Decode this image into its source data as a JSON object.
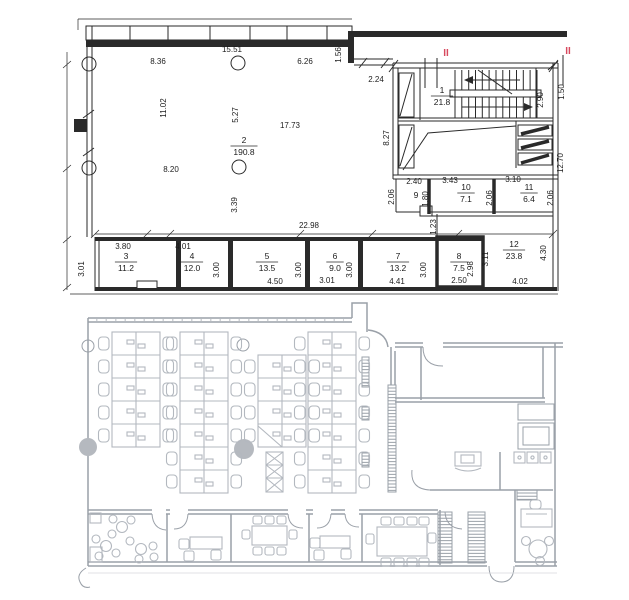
{
  "colors": {
    "ink": "#2a2a2a",
    "gray_wall": "#9aa0a8",
    "gray_furniture": "#b3b8bf",
    "marker_red": "#d84a5f"
  },
  "top_plan": {
    "section_markers": [
      {
        "label": "II",
        "x": 446,
        "y": 56
      },
      {
        "label": "II",
        "x": 568,
        "y": 54
      }
    ],
    "room_labels": [
      {
        "number": "1",
        "area": "21.8",
        "x": 442,
        "y": 96
      },
      {
        "number": "2",
        "area": "190.8",
        "x": 244,
        "y": 146
      },
      {
        "number": "3",
        "area": "11.2",
        "x": 126,
        "y": 262
      },
      {
        "number": "4",
        "area": "12.0",
        "x": 192,
        "y": 262
      },
      {
        "number": "5",
        "area": "13.5",
        "x": 267,
        "y": 262
      },
      {
        "number": "6",
        "area": "9.0",
        "x": 335,
        "y": 262
      },
      {
        "number": "7",
        "area": "13.2",
        "x": 398,
        "y": 262
      },
      {
        "number": "8",
        "area": "7.5",
        "x": 459,
        "y": 262
      },
      {
        "number": "10",
        "area": "7.1",
        "x": 466,
        "y": 193
      },
      {
        "number": "11",
        "area": "6.4",
        "x": 529,
        "y": 193
      },
      {
        "number": "12",
        "area": "23.8",
        "x": 514,
        "y": 250
      }
    ],
    "plain_labels": [
      {
        "text": "9",
        "x": 416,
        "y": 198
      }
    ],
    "dimensions": [
      {
        "text": "15.51",
        "x": 232,
        "y": 52,
        "rot": 0
      },
      {
        "text": "8.36",
        "x": 158,
        "y": 64,
        "rot": 0
      },
      {
        "text": "6.26",
        "x": 305,
        "y": 64,
        "rot": 0
      },
      {
        "text": "1.56",
        "x": 341,
        "y": 55,
        "rot": -90
      },
      {
        "text": "2.24",
        "x": 376,
        "y": 82,
        "rot": 0
      },
      {
        "text": "11.02",
        "x": 166,
        "y": 108,
        "rot": -90
      },
      {
        "text": "5.27",
        "x": 238,
        "y": 115,
        "rot": -90
      },
      {
        "text": "17.73",
        "x": 290,
        "y": 128,
        "rot": 0
      },
      {
        "text": "8.20",
        "x": 171,
        "y": 172,
        "rot": 0
      },
      {
        "text": "3.39",
        "x": 237,
        "y": 205,
        "rot": -90
      },
      {
        "text": "8.27",
        "x": 389,
        "y": 138,
        "rot": -90
      },
      {
        "text": "2.90",
        "x": 543,
        "y": 100,
        "rot": -90
      },
      {
        "text": "1.50",
        "x": 564,
        "y": 92,
        "rot": -90
      },
      {
        "text": "12.70",
        "x": 563,
        "y": 163,
        "rot": -90
      },
      {
        "text": "2.40",
        "x": 414,
        "y": 184,
        "rot": 0
      },
      {
        "text": "2.06",
        "x": 394,
        "y": 197,
        "rot": -90
      },
      {
        "text": "1.80",
        "x": 428,
        "y": 199,
        "rot": -90
      },
      {
        "text": "3.43",
        "x": 450,
        "y": 183,
        "rot": 0
      },
      {
        "text": "2.06",
        "x": 492,
        "y": 198,
        "rot": -90
      },
      {
        "text": "3.10",
        "x": 513,
        "y": 182,
        "rot": 0
      },
      {
        "text": "2.06",
        "x": 553,
        "y": 198,
        "rot": -90
      },
      {
        "text": "1.23",
        "x": 436,
        "y": 227,
        "rot": -90
      },
      {
        "text": "22.98",
        "x": 309,
        "y": 228,
        "rot": 0
      },
      {
        "text": "3.80",
        "x": 123,
        "y": 249,
        "rot": 0
      },
      {
        "text": "3.01",
        "x": 84,
        "y": 269,
        "rot": -90
      },
      {
        "text": "4.01",
        "x": 183,
        "y": 249,
        "rot": 0
      },
      {
        "text": "3.00",
        "x": 219,
        "y": 270,
        "rot": -90
      },
      {
        "text": "4.50",
        "x": 275,
        "y": 284,
        "rot": 0
      },
      {
        "text": "3.00",
        "x": 301,
        "y": 270,
        "rot": -90
      },
      {
        "text": "3.01",
        "x": 327,
        "y": 283,
        "rot": 0
      },
      {
        "text": "3.00",
        "x": 352,
        "y": 270,
        "rot": -90
      },
      {
        "text": "4.41",
        "x": 397,
        "y": 284,
        "rot": 0
      },
      {
        "text": "3.00",
        "x": 426,
        "y": 270,
        "rot": -90
      },
      {
        "text": "2.50",
        "x": 459,
        "y": 283,
        "rot": 0
      },
      {
        "text": "2.98",
        "x": 473,
        "y": 269,
        "rot": -90
      },
      {
        "text": "3.11",
        "x": 488,
        "y": 259,
        "rot": -90
      },
      {
        "text": "4.02",
        "x": 520,
        "y": 284,
        "rot": 0
      },
      {
        "text": "4.30",
        "x": 546,
        "y": 253,
        "rot": -90
      }
    ]
  },
  "bottom_plan": {
    "labels": []
  }
}
